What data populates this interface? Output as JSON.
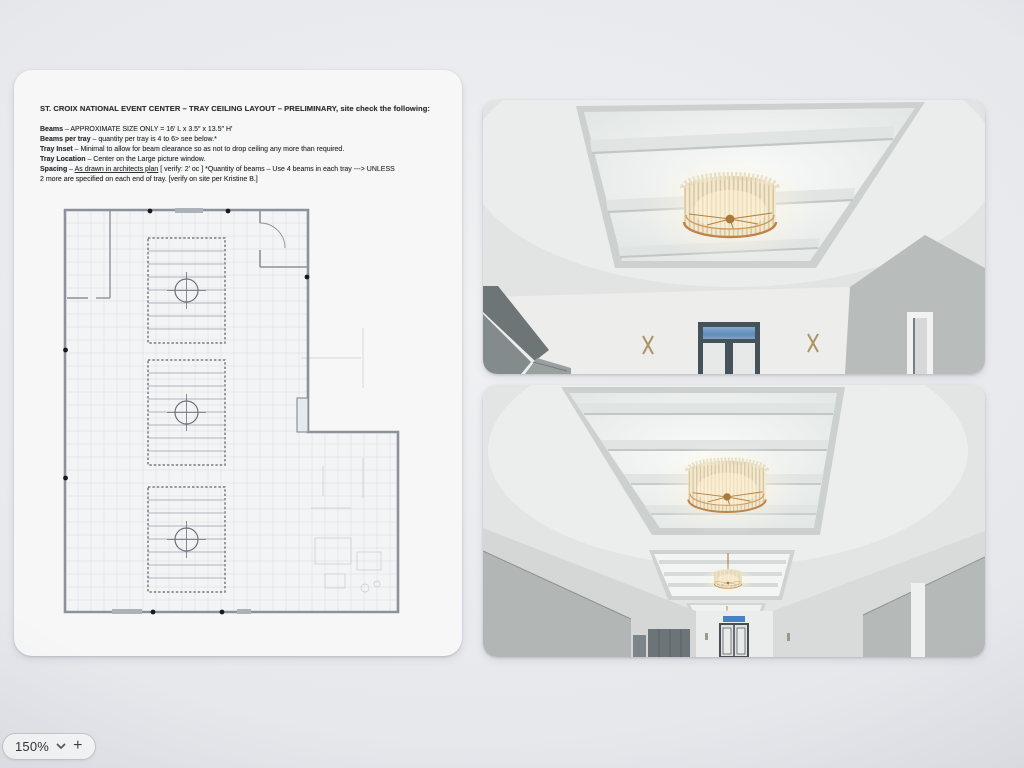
{
  "document": {
    "title": "ST. CROIX NATIONAL EVENT CENTER – TRAY CEILING LAYOUT – PRELIMINARY, site check the following:",
    "lines": [
      {
        "label": "Beams",
        "text": " – APPROXIMATE SIZE ONLY =  16′ L x 3.5″  x 13.5″ H′"
      },
      {
        "label": "Beams per tray",
        "text": " – quantity per tray is 4 to 6> see below.*"
      },
      {
        "label": "Tray Inset",
        "text": " – Minimal to allow for beam clearance so as not to drop ceiling any more than required."
      },
      {
        "label": "Tray Location",
        "text": " – Center on the Large picture window."
      },
      {
        "label": "Spacing",
        "mid": " – ",
        "underline": "As drawn in architects plan",
        "text": " [ verify: 2′ oc ] *Quantity of beams – Use 4 beams in each tray ---> UNLESS"
      },
      {
        "label": "",
        "text": "2 more are specified on each end of tray. [verify on site per Kristine B.]"
      }
    ],
    "floor_plan": {
      "tray_count": 3,
      "chandeliers_per_tray": 1,
      "beam_lines_per_tray": 7
    }
  },
  "zoom_control": {
    "value": "150%",
    "zoom_in_label": "+"
  },
  "colors": {
    "chandelier_brass": "#c08448",
    "chandelier_cream": "#e9dfc4",
    "sky_blue": "#6f9ec7",
    "exit_sign_blue": "#4a80c4",
    "wall_gray": "#b6bab9"
  }
}
